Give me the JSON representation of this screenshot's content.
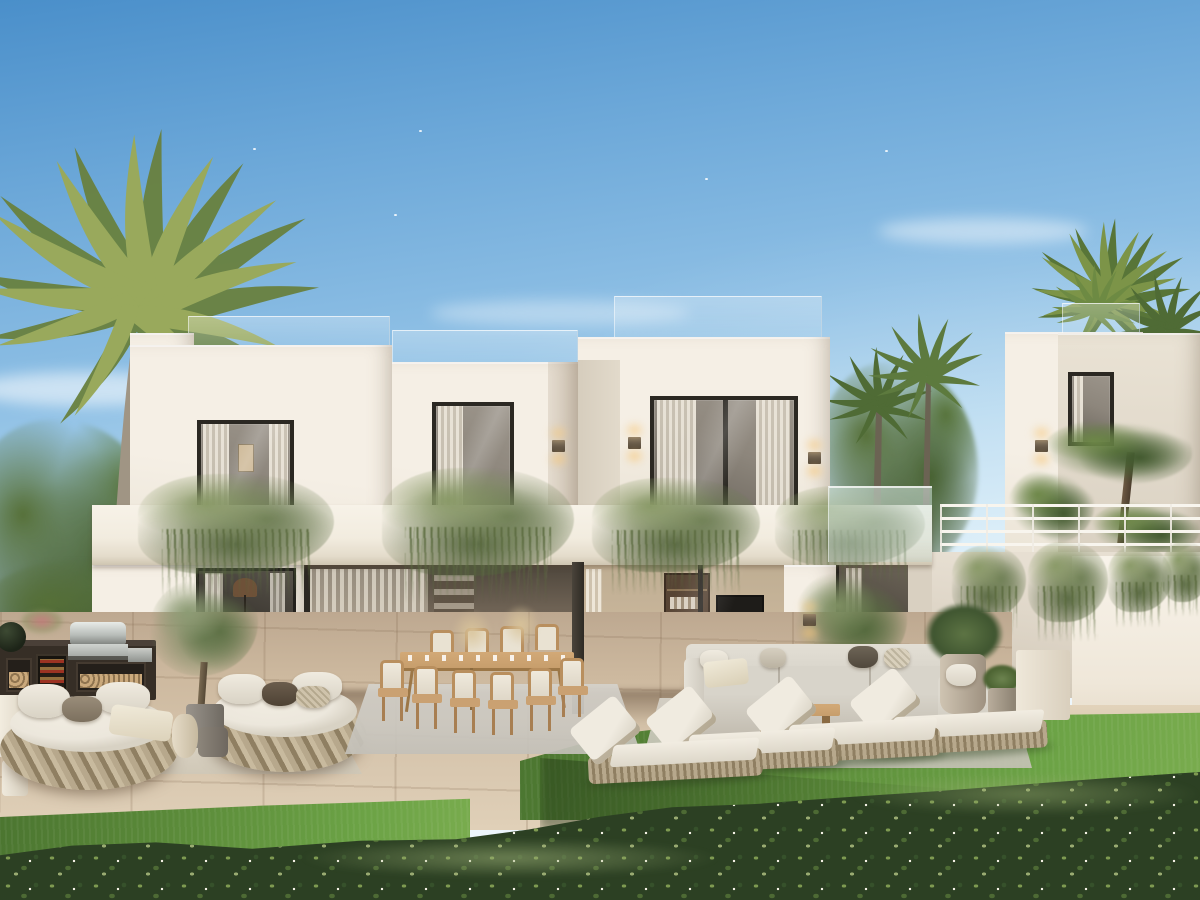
{
  "meta": {
    "title": "Modern luxury villa — exterior rendering",
    "alt": "Photorealistic rendering of a modern two-storey white villa at golden hour with covered terrace, outdoor dining table, round wicker daybeds, outdoor kitchen with barbecue, grey sectional sofa, four sun loungers on a lawn, a turquoise plunge pool, a neighbouring white villa with a bar railing, palm trees and a flowering hedge in the foreground."
  },
  "palette": {
    "sky-top": "#4a8fca",
    "sky-mid": "#8fc0e5",
    "sky-low": "#cfe8f6",
    "sky-horizon": "#e9f4fb",
    "wall-lit": "#f5efe5",
    "wall-mid": "#eae3d5",
    "wall-shade": "#d9d0c1",
    "wall-dark": "#c7bdac",
    "glass-dark": "#8d867c",
    "glass-deep": "#4a463f",
    "frame-dark": "#2b2822",
    "curtain": "#f0eadd",
    "trail-green": "#6f7f55",
    "trail-dark": "#53633e",
    "palm-light": "#97a75b",
    "palm-dark": "#6a8140",
    "tree-dark": "#3c5230",
    "tree-mid": "#567038",
    "grass-light": "#6ba245",
    "grass-dark": "#4b7530",
    "hedge-dark": "#2c4023",
    "hedge-mid": "#4d6a34",
    "hedge-light": "#7e9a51",
    "stone-light": "#d8c7af",
    "stone-mid": "#c3ae94",
    "stone-dark": "#a18a71",
    "wood": "#c79e6c",
    "wicker": "#b7a88c",
    "wicker-dark": "#8f7f62",
    "cushion": "#ece7dc",
    "sofa": "#d8d4ca",
    "sofa-dark": "#c2bcb0",
    "pool-light": "#abd6d0",
    "pool-deep": "#68b0b2",
    "glow": "#f6c87d",
    "cabinet": "#362e26",
    "steel": "#ccd0cd",
    "trunk": "#a09584"
  },
  "scene": {
    "time_of_day": "late afternoon / golden hour",
    "objects": [
      {
        "name": "main-villa",
        "desc": "two-storey flat-roofed white villa with rooftop glass balustrade"
      },
      {
        "name": "upper-bedroom-window",
        "count": 3
      },
      {
        "name": "wall-sconce",
        "count": 7,
        "state": "lit warm"
      },
      {
        "name": "balcony-trailing-plants",
        "count": 4
      },
      {
        "name": "covered-terrace-dining",
        "chairs": 10,
        "table": "light wood, set with glasses and pampas centerpieces"
      },
      {
        "name": "outdoor-kitchen",
        "items": [
          "stainless bbq grill",
          "kamado smoker",
          "wine fridge",
          "firewood cubbies"
        ]
      },
      {
        "name": "round-wicker-daybed",
        "count": 2
      },
      {
        "name": "olive-tree-in-pot",
        "count": 2
      },
      {
        "name": "sectional-sofa",
        "color": "light grey",
        "coffee_table": "wood slab"
      },
      {
        "name": "sun-lounger",
        "count": 4,
        "surface": "lawn"
      },
      {
        "name": "plunge-pool",
        "color": "turquoise"
      },
      {
        "name": "neighbour-villa",
        "features": [
          "white bar railing",
          "hanging plants",
          "topiary pines",
          "rooftop glass with palm"
        ]
      },
      {
        "name": "palm-tree",
        "count": 5
      },
      {
        "name": "flowering-hedge",
        "position": "foreground"
      },
      {
        "name": "stone-tile-terrace"
      },
      {
        "name": "lawn"
      },
      {
        "name": "blue-sky-with-wispy-clouds"
      }
    ]
  }
}
